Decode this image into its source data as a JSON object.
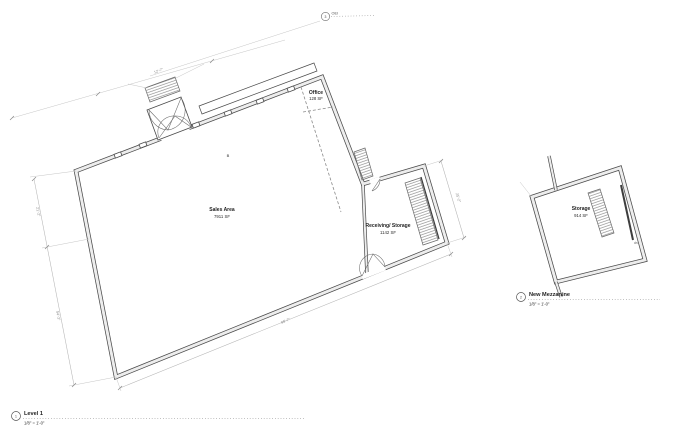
{
  "palette": {
    "paper": "#ffffff",
    "wall_line": "#4a4a4a",
    "dim_line": "#b5b5b5",
    "text": "#1f1f1f",
    "hatch": "#777777"
  },
  "callout": {
    "number": "3",
    "label": "OEI"
  },
  "level1": {
    "title": {
      "number": "1",
      "name": "Level 1",
      "scale": "1/8\" = 1'-0\""
    },
    "rooms": {
      "sales": {
        "name": "Sales Area",
        "area": "7911 SF"
      },
      "receiving": {
        "name": "Receiving/ Storage",
        "area": "1142 SF"
      },
      "office": {
        "name": "Office",
        "area": "128 SF"
      }
    },
    "dims": {
      "top": "12'-7\"",
      "left_upper": "21'-2\"",
      "left_lower": "54'-3\"",
      "bottom": "98'-7\"",
      "right": "25'-2\""
    },
    "door_tag": "B"
  },
  "mezzanine": {
    "title": {
      "number": "2",
      "name": "New Mezzanine",
      "scale": "1/8\" = 1'-0\""
    },
    "rooms": {
      "storage": {
        "name": "Storage",
        "area": "914 SF"
      }
    },
    "stair_label": "dn"
  }
}
